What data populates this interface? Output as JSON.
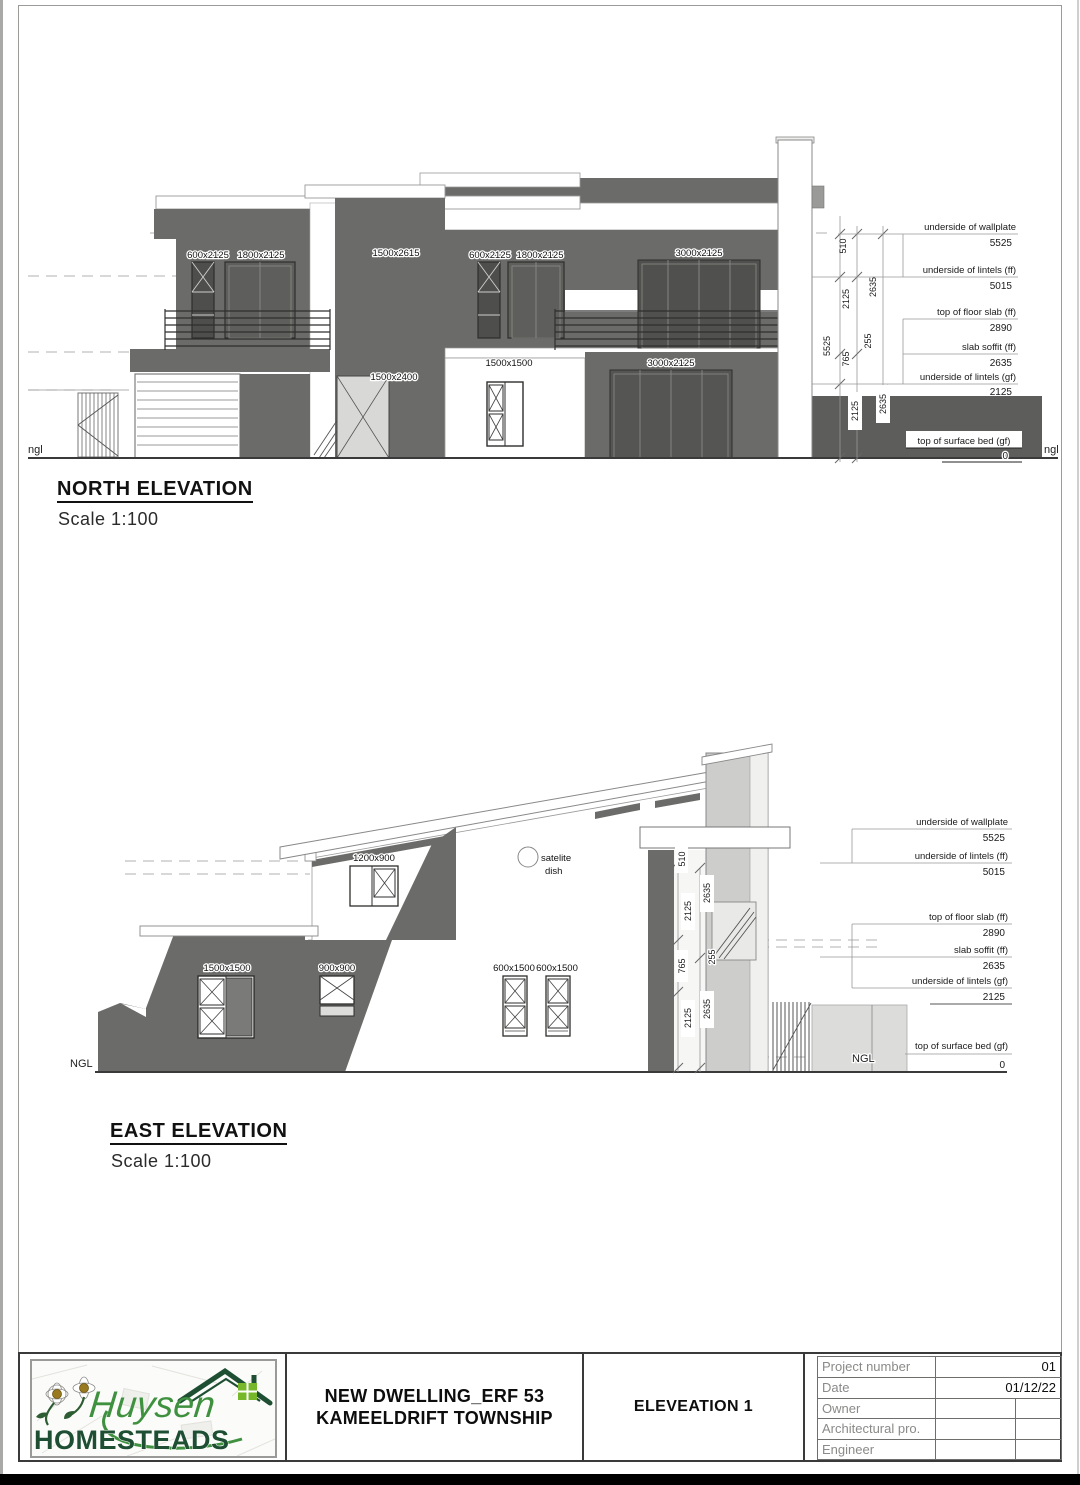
{
  "palette": {
    "wall_dark": "#6b6b69",
    "ground_dark": "#5d5d5b",
    "chimney_gray": "#cdcdcb",
    "logo_green": "#3f9140",
    "logo_dark_green": "#1e4f33"
  },
  "north": {
    "title": "NORTH ELEVATION",
    "scale": "Scale 1:100",
    "ngl_left": "ngl",
    "ngl_right": "ngl",
    "labels": {
      "win1": "600x2125",
      "win2": "1800x2125",
      "win3": "1500x2615",
      "win4": "600x2125",
      "win5": "1800x2125",
      "win6": "3000x2125",
      "win7": "1500x1500",
      "win8": "1500x2400",
      "win9": "3000x2125"
    },
    "levels": [
      {
        "label": "underside of wallplate",
        "value": "5525"
      },
      {
        "label": "underside of lintels (ff)",
        "value": "5015"
      },
      {
        "label": "top of floor slab (ff)",
        "value": "2890"
      },
      {
        "label": "slab soffit (ff)",
        "value": "2635"
      },
      {
        "label": "underside of lintels (gf)",
        "value": "2125"
      },
      {
        "label": "top of surface bed (gf)",
        "value": "0"
      }
    ],
    "dims": {
      "a": "510",
      "b": "2125",
      "c": "2635",
      "d": "5525",
      "e": "765",
      "f": "255",
      "g": "2125",
      "h": "2635"
    }
  },
  "east": {
    "title": "EAST ELEVATION",
    "scale": "Scale 1:100",
    "ngl_left": "NGL",
    "ngl_right": "NGL",
    "satellite": {
      "line1": "satelite",
      "line2": "dish"
    },
    "labels": {
      "win1": "1200x900",
      "win2": "1500x1500",
      "win3": "900x900",
      "win4": "600x1500",
      "win5": "600x1500"
    },
    "levels": [
      {
        "label": "underside of wallplate",
        "value": "5525"
      },
      {
        "label": "underside of lintels (ff)",
        "value": "5015"
      },
      {
        "label": "top of floor slab (ff)",
        "value": "2890"
      },
      {
        "label": "slab soffit (ff)",
        "value": "2635"
      },
      {
        "label": "underside of lintels (gf)",
        "value": "2125"
      },
      {
        "label": "top of surface bed (gf)",
        "value": "0"
      }
    ],
    "dims": {
      "a": "510",
      "b": "2125",
      "c": "2635",
      "d": "765",
      "e": "255",
      "f": "2125",
      "g": "2635"
    }
  },
  "title_block": {
    "brand_script": "Huysen",
    "brand_caps": "HOMESTEADS",
    "project_line1": "NEW DWELLING_ERF 53",
    "project_line2": "KAMEELDRIFT TOWNSHIP",
    "sheet_title": "ELEVEATION 1",
    "fields": [
      {
        "label": "Project number",
        "value": "01"
      },
      {
        "label": "Date",
        "value": "01/12/22"
      },
      {
        "label": "Owner",
        "value": ""
      },
      {
        "label": "Architectural pro.",
        "value": ""
      },
      {
        "label": "Engineer",
        "value": ""
      }
    ]
  }
}
